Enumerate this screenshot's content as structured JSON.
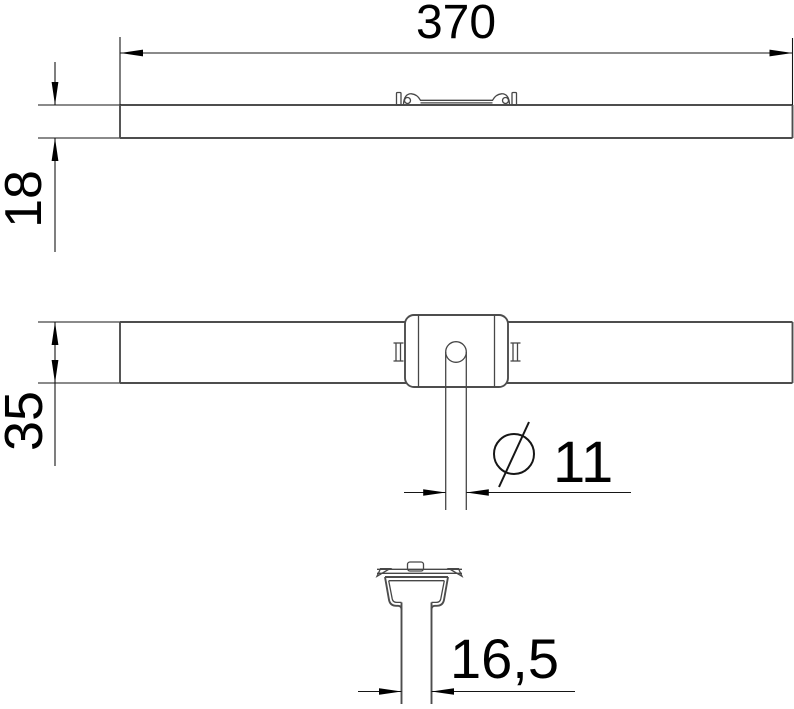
{
  "page": {
    "background": "#ffffff"
  },
  "drawing": {
    "line_color": "#4d4d4d",
    "dimension_color": "#161616",
    "text_color": "#000000",
    "dimensions": {
      "overall_length": "370",
      "profile_height": "18",
      "profile_width": "35",
      "pin_diameter_symbol": "⌀",
      "pin_diameter": "11",
      "stem_width": "16,5"
    }
  }
}
